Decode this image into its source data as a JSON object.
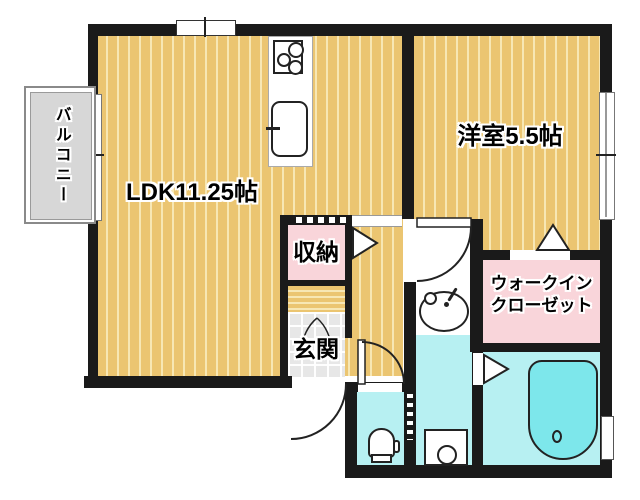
{
  "rooms": {
    "ldk": {
      "label": "LDK11.25帖"
    },
    "western": {
      "label": "洋室5.5帖"
    },
    "storage": {
      "label": "収納"
    },
    "entrance": {
      "label": "玄関"
    },
    "wic": {
      "line1": "ウォークイン",
      "line2": "クローゼット"
    },
    "balcony": {
      "label": "バルコニー"
    }
  },
  "fixtures": {
    "stove": "stove-icon",
    "kitchen_sink": "kitchen-sink-icon",
    "washbasin": "washbasin-icon",
    "toilet": "toilet-icon",
    "bathtub": "bathtub-icon",
    "washing_machine": "washing-machine-icon"
  },
  "colors": {
    "wood": "#EBC571",
    "stripe": "#F7E7B4",
    "pink": "#F9D5DA",
    "cyan": "#B7F0F2",
    "tub": "#7DE7EB",
    "wall": "#1A1A1A",
    "balcony": "#D7D7D7",
    "tile": "#E7E7E7"
  }
}
